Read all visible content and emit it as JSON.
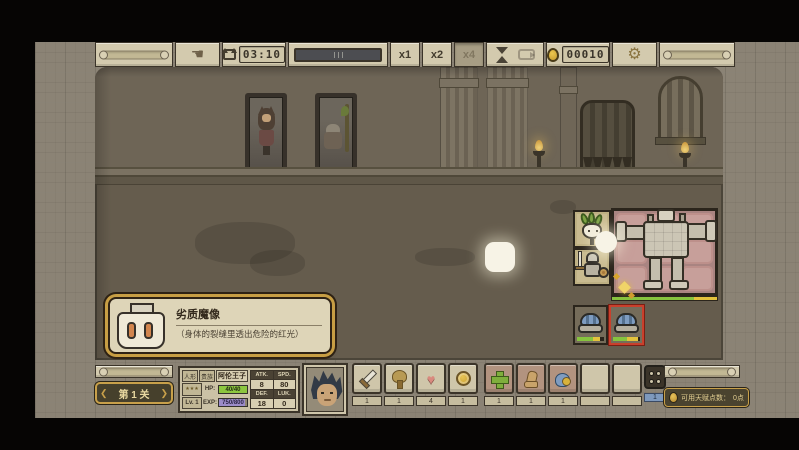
{
  "glyphs": {
    "heart": "♥",
    "gear": "⚙",
    "hand": "☚"
  },
  "top_bar": {
    "timer_value": "03:10",
    "gold_value": "00010",
    "speed_options": [
      {
        "label": "x1",
        "active": false
      },
      {
        "label": "x2",
        "active": false
      },
      {
        "label": "x4",
        "active": true
      }
    ]
  },
  "scene": {
    "tooltip": {
      "title": "劣质魔像",
      "description": "（身体的裂缝里透出危险的红光）"
    }
  },
  "bottom_bar": {
    "stage": {
      "prev_glyph": "❮",
      "label": "第 1 关",
      "next_glyph": "❯"
    },
    "character": {
      "tag1": "人形",
      "tag2": "贵族",
      "name": "阿伦王子",
      "rank_stars": "★★★",
      "level": "Lv. 1",
      "hp_label": "HP:",
      "hp_value": "40/40",
      "exp_label": "EXP:",
      "exp_value": "750/800",
      "stats": [
        {
          "label": "ATK.",
          "value": "8"
        },
        {
          "label": "SPD.",
          "value": "80"
        },
        {
          "label": "DEF.",
          "value": "18"
        },
        {
          "label": "LUK.",
          "value": "0"
        }
      ]
    },
    "consumable_slots": [
      {
        "icon": "sword-icon",
        "count": "1"
      },
      {
        "icon": "tree-icon",
        "count": "1"
      },
      {
        "icon": "heart-icon",
        "count": "4"
      },
      {
        "icon": "coin-icon",
        "count": "1"
      }
    ],
    "material_slots": [
      {
        "icon": "cross-icon",
        "count": "1"
      },
      {
        "icon": "boot-icon",
        "count": "1"
      },
      {
        "icon": "blue-creature-icon",
        "count": "1"
      }
    ],
    "page_indicator": "1",
    "talent": {
      "label": "可用天赋点数：",
      "value": "0点"
    }
  },
  "colors": {
    "accent_gold": "#c8a04a",
    "hp_green": "#8cc63f",
    "exp_purple": "#9c8cc9",
    "enemy_highlight_red": "#c9402c",
    "grid_pink": "#c79f9a",
    "grid_tan": "#c8ba8e"
  }
}
